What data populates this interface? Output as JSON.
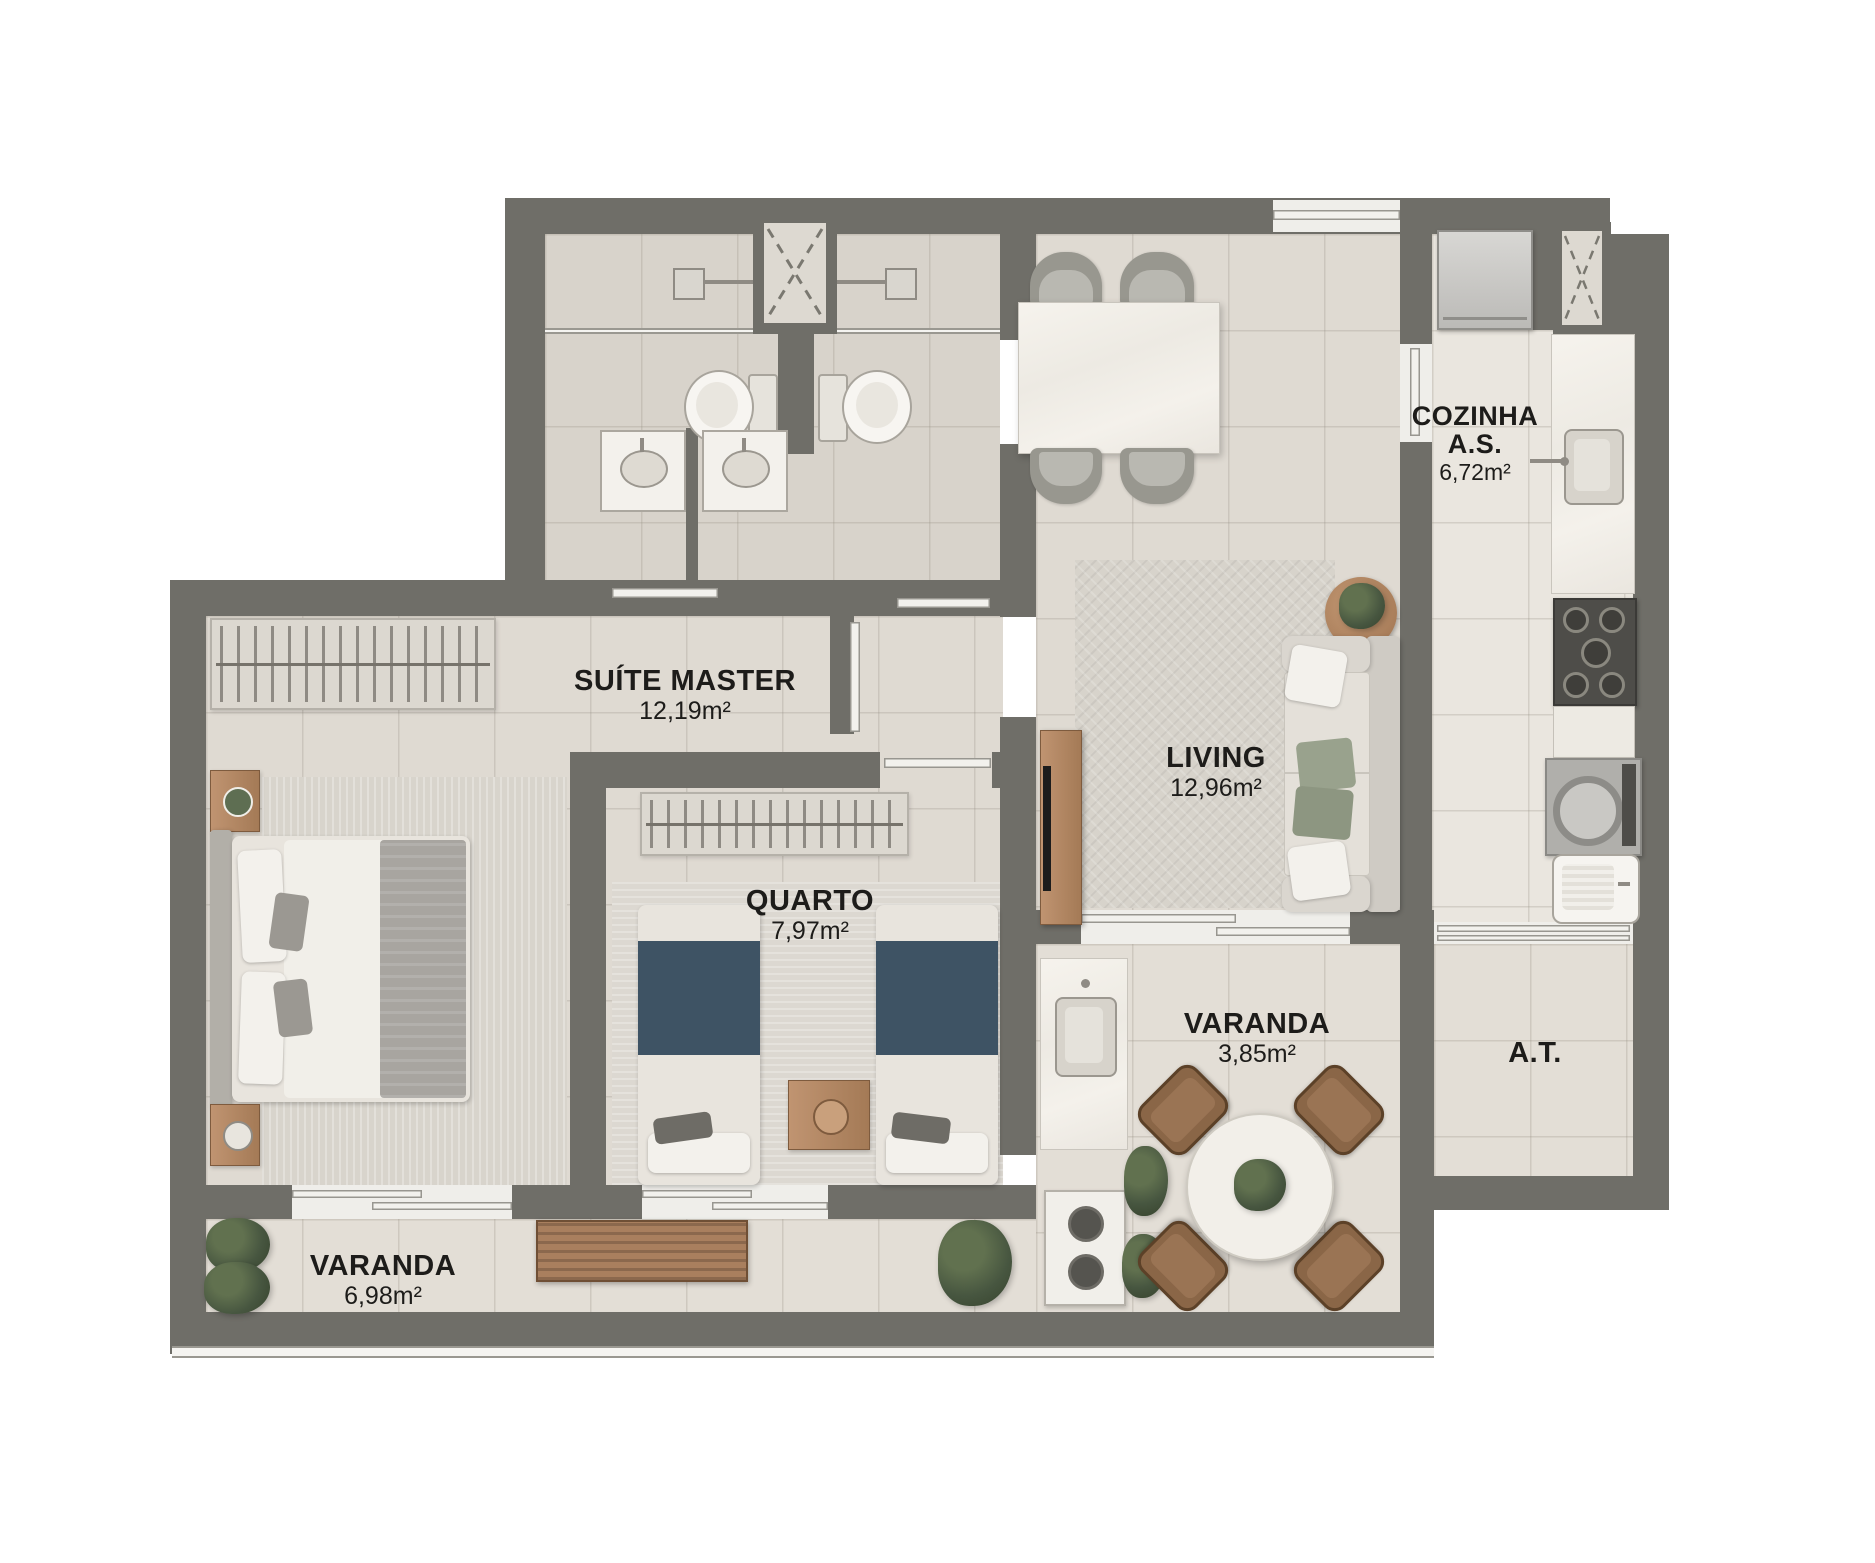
{
  "title": "Apartment floor plan",
  "rooms": {
    "cozinha": {
      "name": "COZINHA",
      "name2": "A.S.",
      "area": "6,72m²"
    },
    "suite": {
      "name": "SUÍTE MASTER",
      "area": "12,19m²"
    },
    "living": {
      "name": "LIVING",
      "area": "12,96m²"
    },
    "quarto": {
      "name": "QUARTO",
      "area": "7,97m²"
    },
    "varanda_gourmet": {
      "name": "VARANDA",
      "area": "3,85m²"
    },
    "at": {
      "name": "A.T."
    },
    "varanda": {
      "name": "VARANDA",
      "area": "6,98m²"
    }
  },
  "palette": {
    "wall": "#6F6E68",
    "floor_tile": "#DFDAD2",
    "floor_bath": "#D8D3CB",
    "floor_kitchen": "#EAE6DF",
    "marble": "#F4F1EB",
    "wood": "#A97F5E",
    "blanket_blue": "#3E5364",
    "plant_green": "#475640",
    "label_text": "#1D1C1A"
  }
}
